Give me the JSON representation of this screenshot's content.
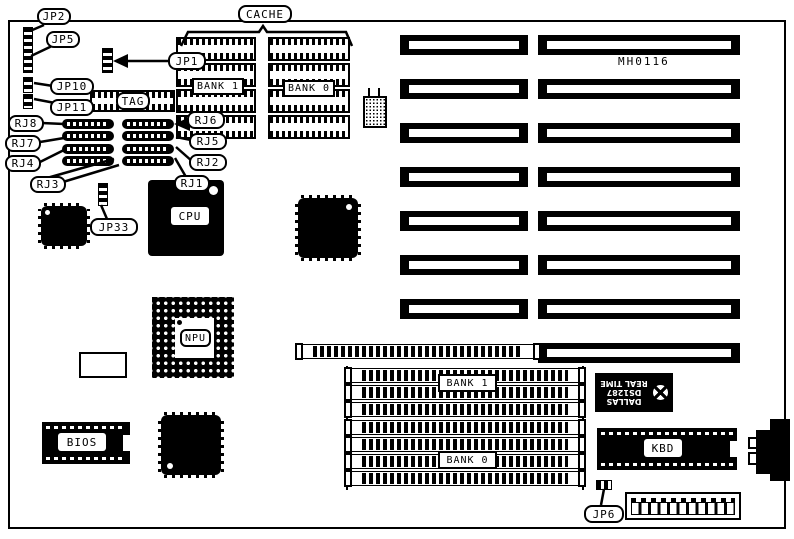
{
  "diagram": {
    "type": "motherboard layout diagram",
    "board_id": "MH0116"
  },
  "labels": {
    "cache": "CACHE",
    "tag": "TAG",
    "jp2": "JP2",
    "jp5": "JP5",
    "jp1": "JP1",
    "jp10": "JP10",
    "jp11": "JP11",
    "jp33": "JP33",
    "jp6": "JP6",
    "rj8": "RJ8",
    "rj7": "RJ7",
    "rj4": "RJ4",
    "rj3": "RJ3",
    "rj6": "RJ6",
    "rj5": "RJ5",
    "rj2": "RJ2",
    "rj1": "RJ1",
    "cpu": "CPU",
    "npu": "NPU",
    "bios": "BIOS",
    "kbd": "KBD",
    "cache_bank_1": "BANK 1",
    "cache_bank_0": "BANK 0",
    "simm_bank_1": "BANK 1",
    "simm_bank_0": "BANK 0",
    "board_id": "MH0116",
    "rtc": {
      "line1": "DALLAS",
      "line2": "DS1287",
      "line3": "REAL TIME"
    }
  },
  "structure": {
    "isa_slots": {
      "left_column": 7,
      "right_column": 8
    },
    "cache_chips_per_bank": 4,
    "simm_slots_total": 8,
    "rj_strip_rows": 4,
    "rj_strip_columns": 2
  },
  "colors": {
    "ink": "#000000",
    "paper": "#ffffff"
  }
}
